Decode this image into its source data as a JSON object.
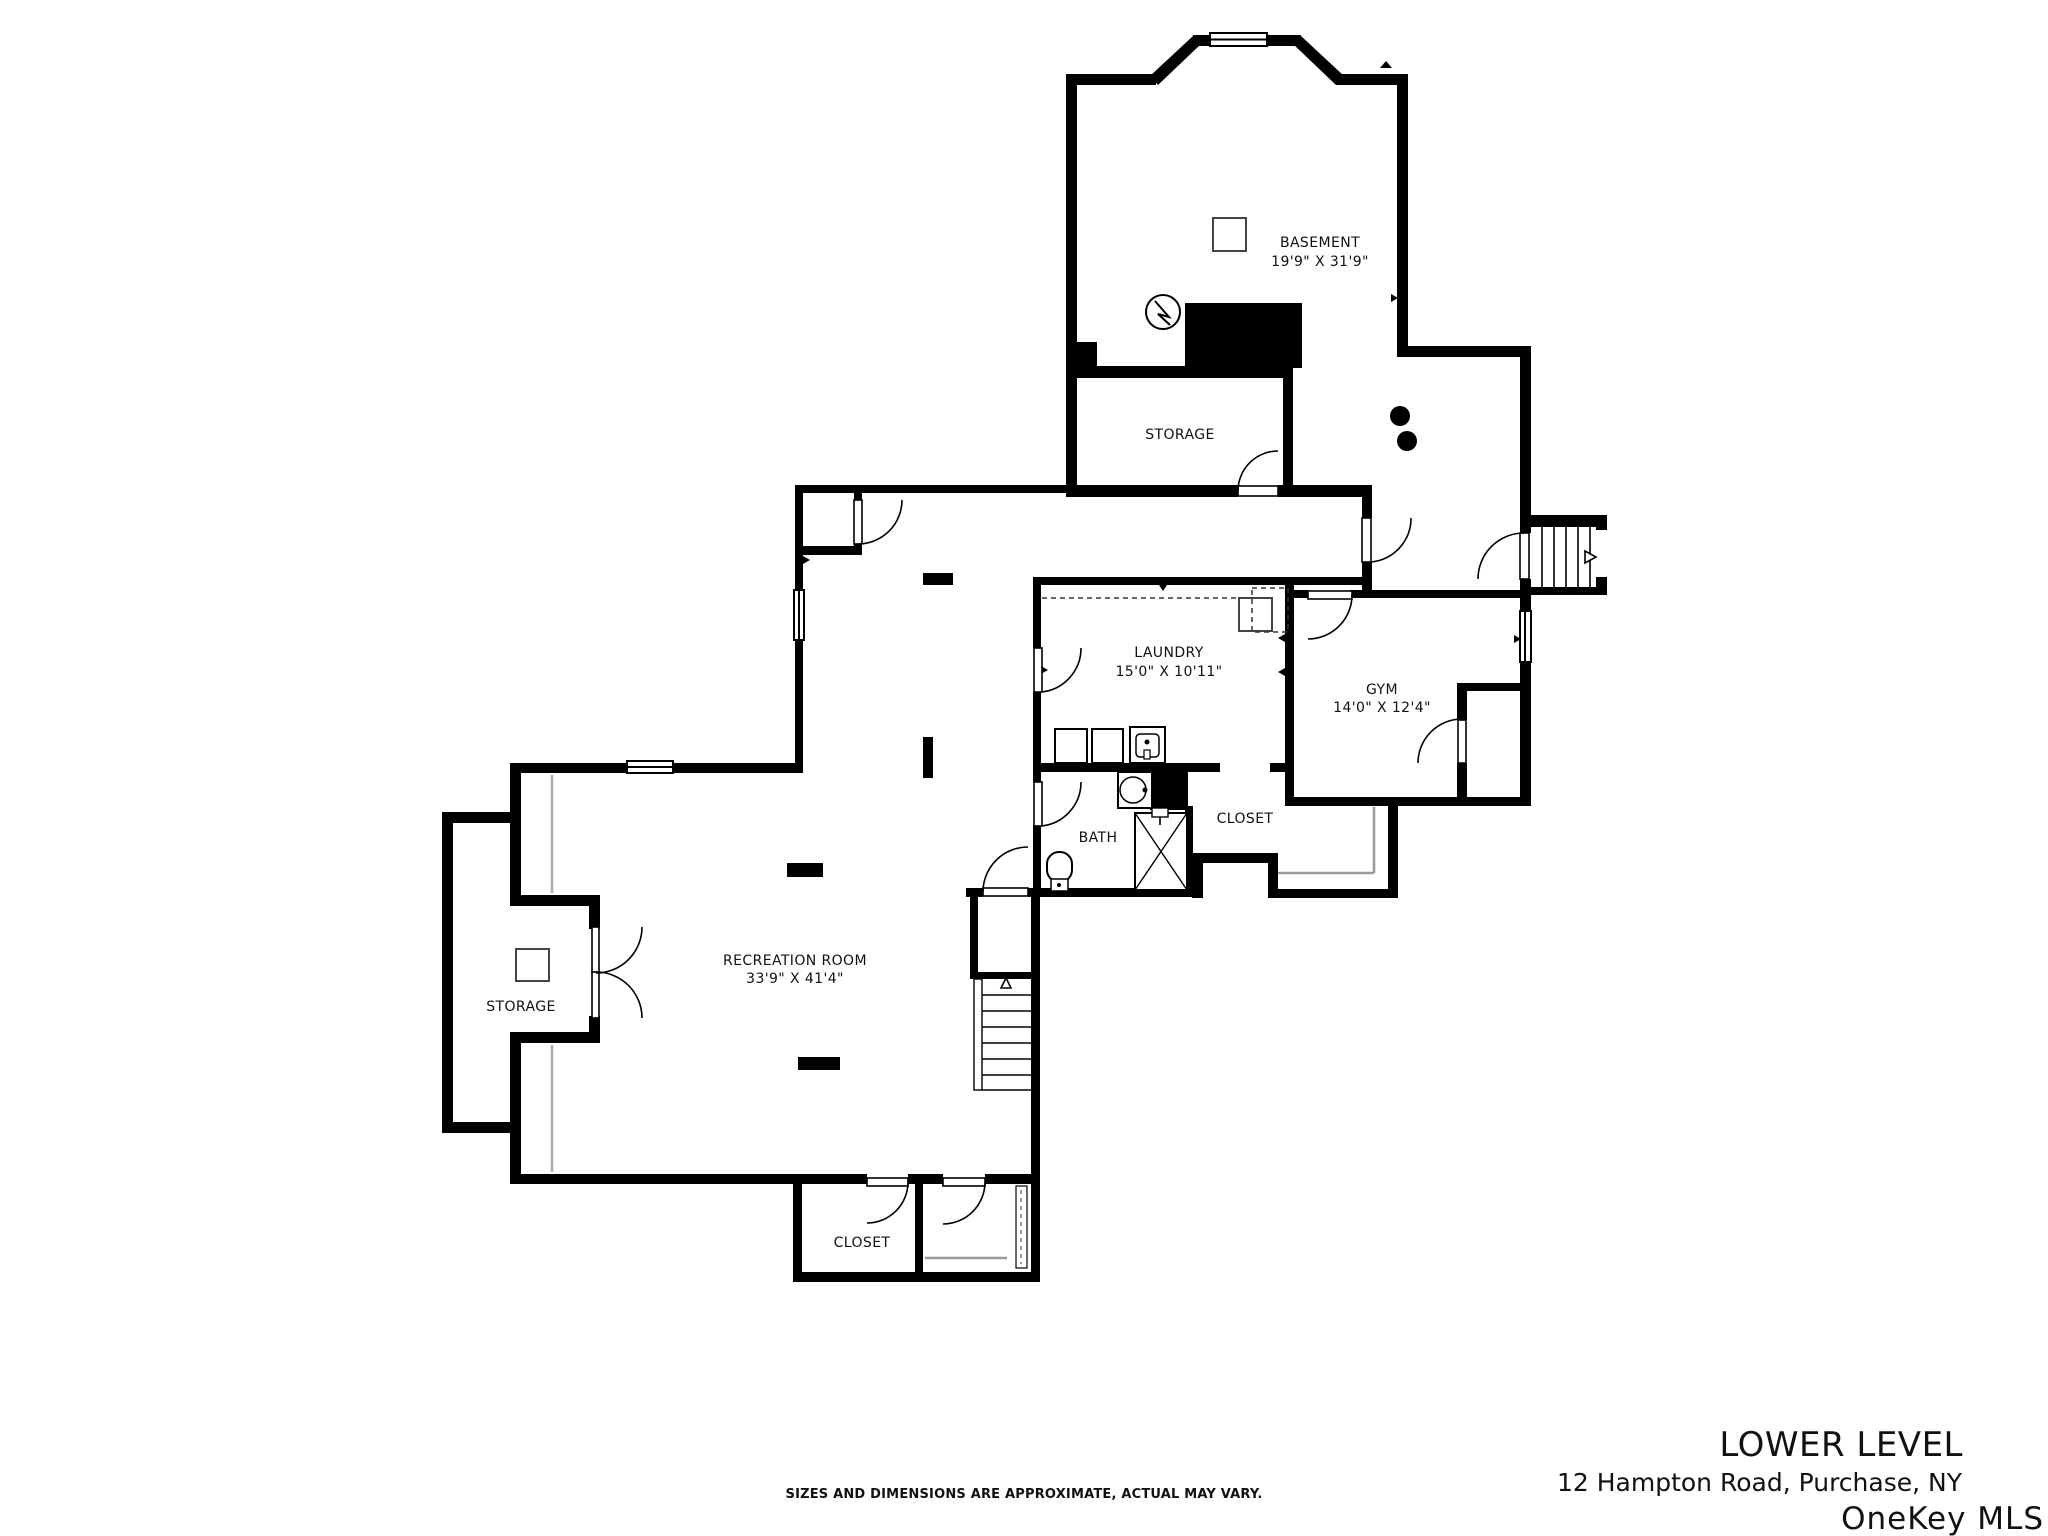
{
  "rooms": {
    "basement": {
      "name": "BASEMENT",
      "dims": "19'9\" X 31'9\""
    },
    "storage_upper": {
      "name": "STORAGE"
    },
    "laundry": {
      "name": "LAUNDRY",
      "dims": "15'0\" X 10'11\""
    },
    "gym": {
      "name": "GYM",
      "dims": "14'0\" X 12'4\""
    },
    "bath": {
      "name": "BATH"
    },
    "closet_gym": {
      "name": "CLOSET"
    },
    "recreation": {
      "name": "RECREATION ROOM",
      "dims": "33'9\" X 41'4\""
    },
    "storage_left": {
      "name": "STORAGE"
    },
    "closet_lower": {
      "name": "CLOSET"
    }
  },
  "footer": {
    "disclaimer": "SIZES AND DIMENSIONS ARE APPROXIMATE, ACTUAL MAY VARY.",
    "title": "LOWER LEVEL",
    "address": "12 Hampton Road, Purchase, NY",
    "watermark": "OneKey MLS"
  },
  "colors": {
    "wall": "#000000",
    "label": "#111111",
    "watermark": "#b4b4b4",
    "shelf": "#9a9a9a",
    "overhang": "#ababab"
  }
}
